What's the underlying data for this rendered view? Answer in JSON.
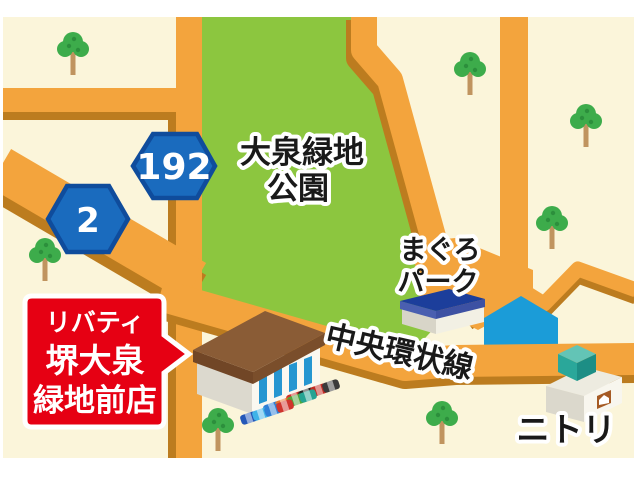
{
  "park": {
    "name_line1": "大泉緑地",
    "name_line2": "公園"
  },
  "route_badges": [
    {
      "number": "192"
    },
    {
      "number": "2"
    }
  ],
  "places": {
    "maguro_park_line1": "まぐろ",
    "maguro_park_line2": "パーク",
    "road_name": "中央環状線",
    "nitori": "ニトリ"
  },
  "store_sign": {
    "line1": "リバティ",
    "line2": "堺大泉",
    "line3": "緑地前店"
  },
  "colors": {
    "map_background": "#FBF5DA",
    "park_green": "#8CC63F",
    "road_orange": "#F3A43D",
    "road_shadow": "#BC7C1F",
    "route_badge_blue": "#1A6BBE",
    "route_badge_border": "#0F4C9C",
    "store_sign_red": "#E60013",
    "blue_building": "#1B9CD8"
  }
}
